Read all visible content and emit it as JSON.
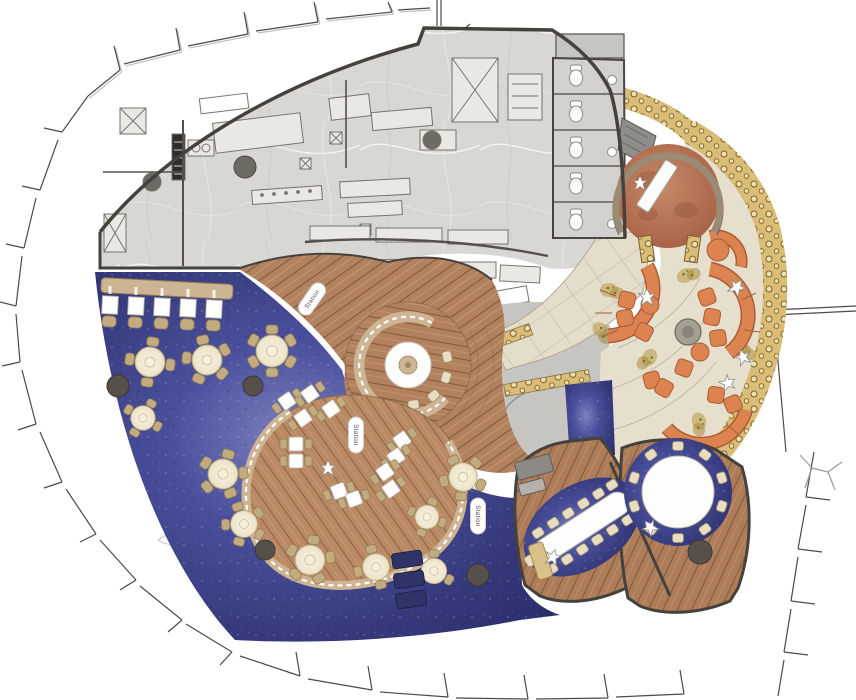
{
  "document": {
    "type": "architectural-floor-plan",
    "subject": "Restaurant dining level – colored plan rendering",
    "note": "Only text rendered on the drawing: three 'Station' service labels"
  },
  "labels": {
    "station_1": "Station",
    "station_2": "Station",
    "station_3": "Station"
  },
  "zones": [
    {
      "id": "boh-kitchen",
      "label": "Back-of-house kitchen (gray marble floor)"
    },
    {
      "id": "restrooms",
      "label": "Restroom stall block (5 stalls)"
    },
    {
      "id": "entry-rotunda",
      "label": "Circular entry rotunda with reception desk"
    },
    {
      "id": "terrace-lounge",
      "label": "Stone terrace lounge with curved orange banquettes"
    },
    {
      "id": "mosaic-border",
      "label": "Gold mosaic tile border band"
    },
    {
      "id": "main-dining",
      "label": "Main dining room on indigo carpet"
    },
    {
      "id": "booth-row",
      "label": "Row of five booths on banquette"
    },
    {
      "id": "banquette-island",
      "label": "Curved banquette island with square tables"
    },
    {
      "id": "round-banquette",
      "label": "Circular banquette with round table on wood platform"
    },
    {
      "id": "stone-path",
      "label": "Stone tile entry path"
    },
    {
      "id": "pdr-long",
      "label": "Private dining room, long table"
    },
    {
      "id": "pdr-round",
      "label": "Private dining room, round table"
    }
  ],
  "counts": {
    "carpet_dining_tables": 12,
    "booths": 5,
    "island_tables": 12,
    "restroom_stalls": 5,
    "pdr_long_seats": 14,
    "pdr_round_seats": 10,
    "terrace_ottomans": 11,
    "terrace_banquettes": 5,
    "service_stations": 5,
    "station_labels": 3,
    "person_figures": 8
  },
  "palette": {
    "exterior": "#ffffff",
    "facade_line": "#4b4b4b",
    "kitchen_floor": "#d8d7d4",
    "wall": "#45423e",
    "carpet_mid": "#4a4f9b",
    "carpet_dark": "#2e3278",
    "wood_plank": "#b2825f",
    "wood_stripe": "#7e5639",
    "banquette_tan": "#cdb493",
    "chair_tan": "#c3ab80",
    "table_cream": "#f2ebd7",
    "stone_tile": "#e7dfcd",
    "mosaic_gold": "#d9bd76",
    "terracotta_seat": "#dd8350",
    "rotunda_floor": "#b06a4e",
    "navy_counter": "#2f3468",
    "white_fixture": "#fbfbf9"
  }
}
